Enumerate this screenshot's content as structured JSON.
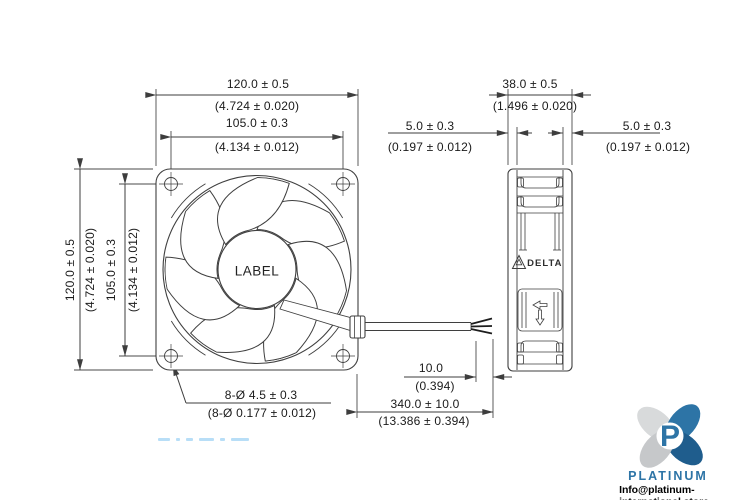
{
  "front_view": {
    "hub_label": "LABEL",
    "dims": {
      "width_mm": "120.0 ± 0.5",
      "width_in": "(4.724 ± 0.020)",
      "hole_pitch_h_mm": "105.0 ± 0.3",
      "hole_pitch_h_in": "(4.134 ± 0.012)",
      "height_mm": "120.0 ± 0.5",
      "height_in": "(4.724 ± 0.020)",
      "hole_pitch_v_mm": "105.0 ± 0.3",
      "hole_pitch_v_in": "(4.134 ± 0.012)",
      "mounting_holes_mm": "8-Ø 4.5 ± 0.3",
      "mounting_holes_in": "(8-Ø 0.177 ± 0.012)"
    }
  },
  "side_view": {
    "brand": "DELTA",
    "dims": {
      "depth_mm": "38.0 ± 0.5",
      "depth_in": "(1.496 ± 0.020)",
      "flange_left_mm": "5.0 ± 0.3",
      "flange_left_in": "(0.197 ± 0.012)",
      "flange_right_mm": "5.0 ± 0.3",
      "flange_right_in": "(0.197 ± 0.012)"
    }
  },
  "lead_wire": {
    "strip_length_mm": "10.0",
    "strip_length_in": "(0.394)",
    "length_mm": "340.0 ± 10.0",
    "length_in": "(13.386 ± 0.394)"
  },
  "branding": {
    "logo_initial": "P",
    "logo_text": "PLATINUM",
    "email": "Info@platinum-international.store",
    "colors": {
      "logo_blue": "#2d74a6",
      "logo_dark_blue": "#1f5d8d",
      "logo_gray": "#c9cbcc",
      "line_color": "#454545"
    }
  }
}
